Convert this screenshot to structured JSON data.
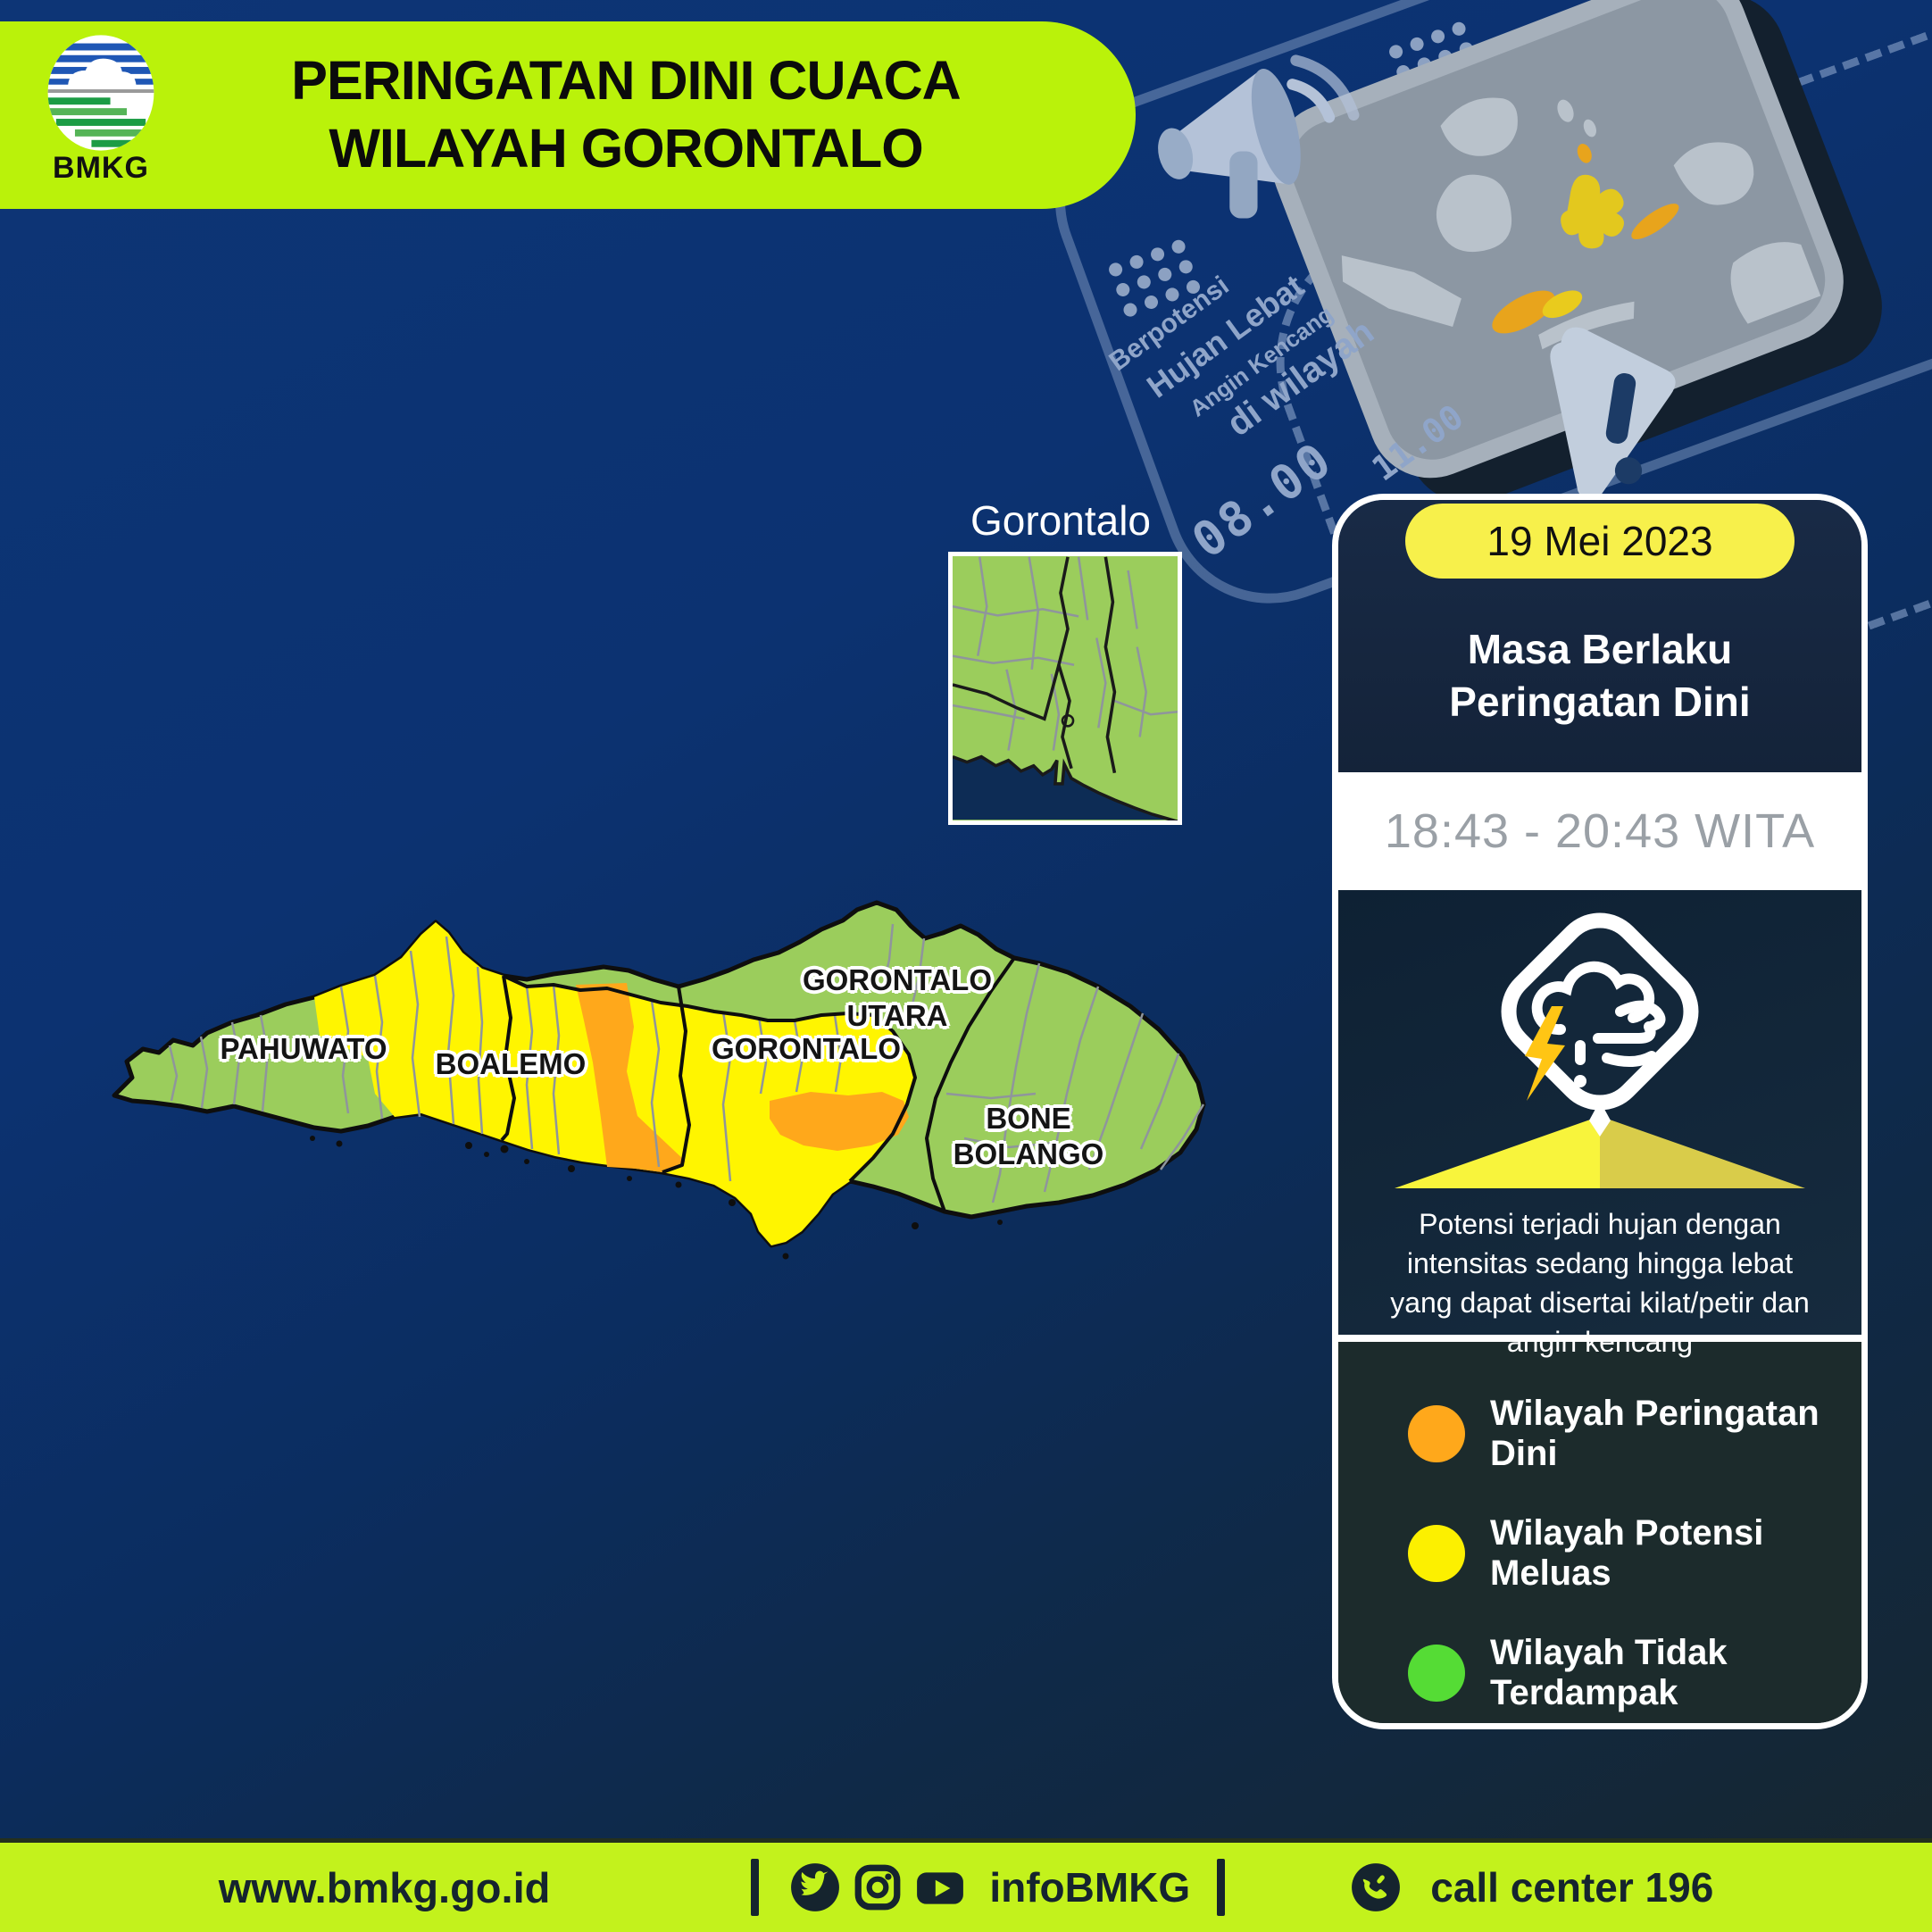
{
  "banner": {
    "title_line1": "PERINGATAN DINI CUACA",
    "title_line2": "WILAYAH GORONTALO",
    "logo_label": "BMKG"
  },
  "illustration": {
    "label_berpotensi": "Berpotensi",
    "label_hujan_lebat": "Hujan Lebat",
    "label_angin_kencang": "Angin Kencang",
    "label_di_wilayah": "di wilayah",
    "clock_primary": "08.00",
    "clock_secondary": "11.00"
  },
  "inset_map": {
    "title": "Gorontalo"
  },
  "map": {
    "labels": {
      "pahuwato": "PAHUWATO",
      "boalemo": "BOALEMO",
      "gorontalo": "GORONTALO",
      "gorontalo_utara_line1": "GORONTALO",
      "gorontalo_utara_line2": "UTARA",
      "bone_bolango": "BONE BOLANGO"
    },
    "region_colors": {
      "warning_orange": "#FFA81B",
      "potential_yellow": "#FFF500",
      "unaffected_green": "#9BCD5C"
    }
  },
  "card": {
    "date": "19 Mei 2023",
    "validity_line1": "Masa Berlaku",
    "validity_line2": "Peringatan Dini",
    "time_range": "18:43 - 20:43 WITA",
    "description_lines": [
      "Potensi terjadi hujan dengan",
      "intensitas sedang hingga lebat",
      "yang dapat disertai kilat/petir dan",
      "angin kencang"
    ]
  },
  "legend": {
    "items": [
      {
        "label": "Wilayah Peringatan Dini",
        "color": "#FFA81B"
      },
      {
        "label": "Wilayah Potensi Meluas",
        "color": "#FCF000"
      },
      {
        "label": "Wilayah Tidak Terdampak",
        "color": "#55DC35"
      }
    ]
  },
  "footer": {
    "website": "www.bmkg.go.id",
    "separator": "|",
    "social_handle": "infoBMKG",
    "call_center": "call center 196"
  },
  "icons": {
    "logo": "bmkg-logo",
    "social": [
      "twitter-icon",
      "instagram-icon",
      "youtube-icon"
    ],
    "call": "phone-icon",
    "weather": "storm-warning-icon",
    "decorative": [
      "megaphone-icon",
      "phone-map-illustration",
      "warning-pointer-icon"
    ]
  },
  "colors": {
    "lime_banner": "#BAF20A",
    "lime_footer": "#C3F21C",
    "background_navy": "#0C3273",
    "card_navy": "#15273E",
    "legend_bg": "#1C2B2C",
    "date_pill_yellow": "#F7F04B"
  }
}
